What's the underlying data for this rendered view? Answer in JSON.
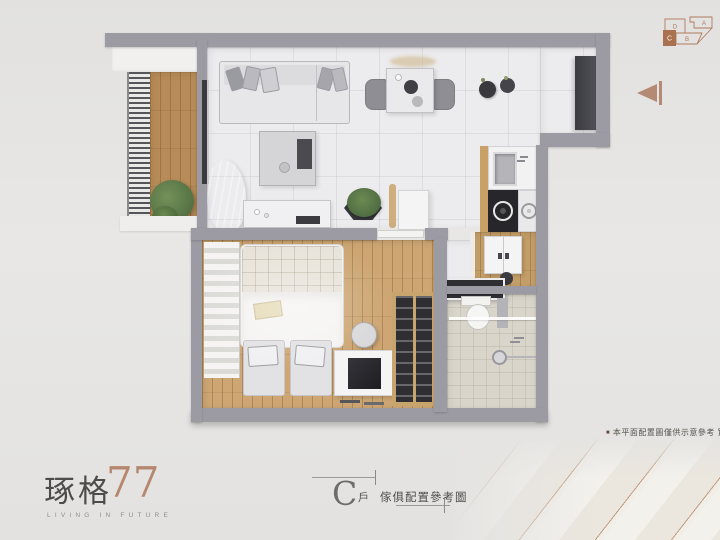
{
  "logo": {
    "brand": "琢格",
    "number": "77",
    "tagline": "LIVING IN FUTURE"
  },
  "caption": {
    "letter": "C",
    "suffix": "戶",
    "title": "傢俱配置參考圖"
  },
  "disclaimer": {
    "bullet": "■",
    "text": "本平面配置圖僅供示意參考 實際以交屋"
  },
  "key_plan": {
    "highlighted": "C",
    "units": [
      {
        "label": "D"
      },
      {
        "label": "A"
      },
      {
        "label": "B"
      },
      {
        "label": "C"
      }
    ]
  },
  "colors": {
    "accent": "#b07a5e",
    "wall": "#9c9ba3",
    "balcony_wood": "#b88c58",
    "bedroom_wood": "#cda673",
    "bath_tile": "#d9d5cb",
    "cabinet_dark": "#3e3e44",
    "ink": "#4d4c4a"
  },
  "plan_rooms": [
    "balcony",
    "living-room",
    "dining-area",
    "kitchen",
    "entry",
    "bedroom",
    "laundry-nook",
    "bathroom"
  ]
}
